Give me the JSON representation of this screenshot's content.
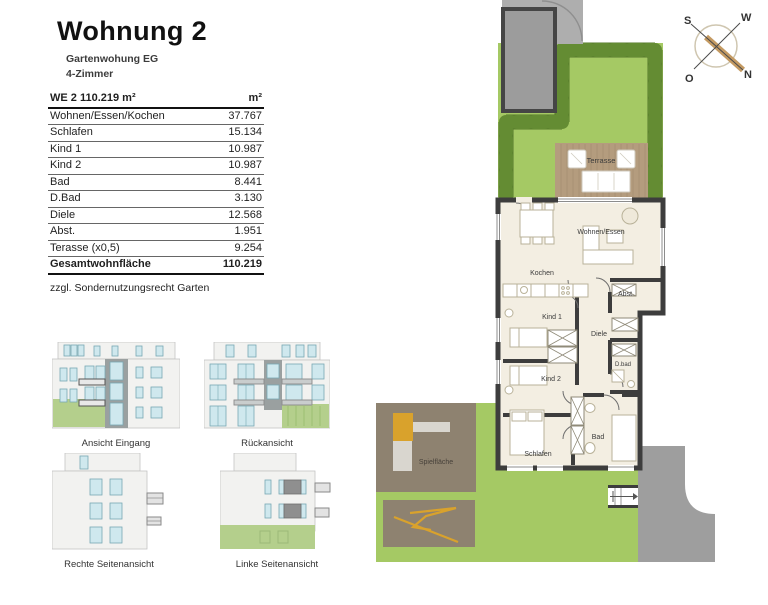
{
  "header": {
    "title": "Wohnung 2",
    "subtitle_line1": "Gartenwohung EG",
    "subtitle_line2": "4-Zimmer"
  },
  "area_table": {
    "title": "WE 2  110.219 m²",
    "unit": "m²",
    "rows": [
      {
        "label": "Wohnen/Essen/Kochen",
        "value": "37.767"
      },
      {
        "label": "Schlafen",
        "value": "15.134"
      },
      {
        "label": "Kind 1",
        "value": "10.987"
      },
      {
        "label": "Kind 2",
        "value": "10.987"
      },
      {
        "label": "Bad",
        "value": "8.441"
      },
      {
        "label": "D.Bad",
        "value": "3.130"
      },
      {
        "label": "Diele",
        "value": "12.568"
      },
      {
        "label": "Abst.",
        "value": "1.951"
      },
      {
        "label": "Terasse (x0,5)",
        "value": "9.254"
      }
    ],
    "total_label": "Gesamtwohnfläche",
    "total_value": "110.219"
  },
  "note": "zzgl. Sondernutzungsrecht Garten",
  "elevations": {
    "front_label": "Ansicht Eingang",
    "back_label": "Rückansicht",
    "right_label": "Rechte Seitenansicht",
    "left_label": "Linke Seitenansicht"
  },
  "compass": {
    "north": "N",
    "south": "S",
    "west": "W",
    "east": "O"
  },
  "floor_plan": {
    "rooms": {
      "terrasse": "Terrasse",
      "wohnen_essen": "Wohnen/Essen",
      "kochen": "Kochen",
      "abst": "Abst.",
      "kind1": "Kind 1",
      "diele": "Diele",
      "kind2": "Kind 2",
      "dbad": "D.bad",
      "bad": "Bad",
      "schlafen": "Schlafen",
      "spielflaeche": "Spielfläche"
    }
  },
  "colors": {
    "lawn": "#a5c964",
    "hedge": "#55782b",
    "terrace_wood": "#b49c7e",
    "wall": "#3d3d3d",
    "floor": "#f3eee2",
    "path_gray": "#9e9e9e",
    "play_area": "#8e8270",
    "play_equipment": "#d9a22c",
    "window_blue": "#cfe8ee",
    "elevation_green": "#b4cf8c"
  }
}
